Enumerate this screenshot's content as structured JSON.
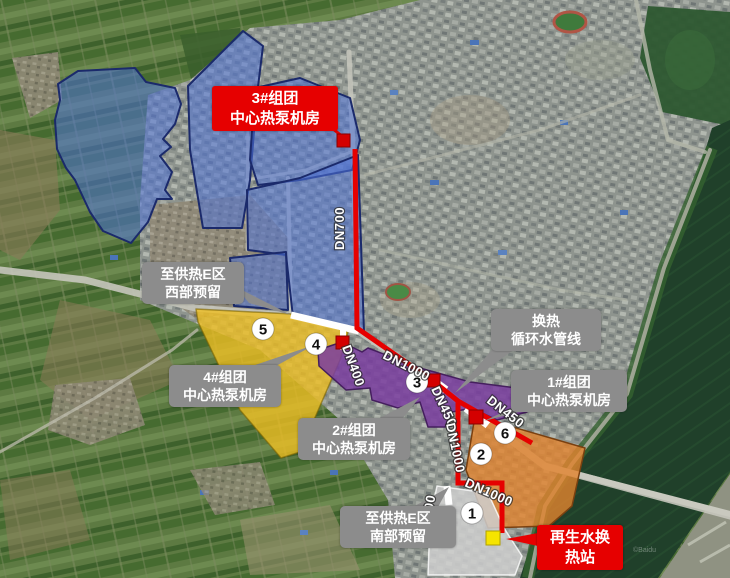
{
  "map": {
    "title_boxes": {
      "group3": {
        "line1": "3#组团",
        "line2": "中心热泵机房"
      },
      "west_reserve": {
        "line1": "至供热E区",
        "line2": "西部预留"
      },
      "group4": {
        "line1": "4#组团",
        "line2": "中心热泵机房"
      },
      "group2": {
        "line1": "2#组团",
        "line2": "中心热泵机房"
      },
      "heat_exchange": {
        "line1": "换热",
        "line2": "循环水管线"
      },
      "group1": {
        "line1": "1#组团",
        "line2": "中心热泵机房"
      },
      "south_reserve": {
        "line1": "至供热E区",
        "line2": "南部预留"
      },
      "reclaimed_water": {
        "line1": "再生水换",
        "line2": "热站"
      }
    },
    "pipe_labels": {
      "dn700_north": "DN700",
      "dn1000_main": "DN1000",
      "dn400": "DN400",
      "dn450_mid": "DN450",
      "dn450_east": "DN450",
      "dn1000_south": "DN1000",
      "dn1000_bottom": "DN1000",
      "dn700_south": "DN700"
    },
    "station_numbers": {
      "n1": "1",
      "n2": "2",
      "n3": "3",
      "n4": "4",
      "n5": "5",
      "n6": "6"
    },
    "watermark": "©Baidu",
    "colors": {
      "pipe_red": "#e60000",
      "zone_blue": "#4e73d8",
      "zone_yellow": "#edbe23",
      "zone_purple": "#7a3da0",
      "zone_orange": "#e2832e",
      "zone_gray": "#cfcfcf",
      "label_gray": "#8c8c8c",
      "marker_yellow": "#f6e400",
      "river_green": "#20402a"
    }
  }
}
